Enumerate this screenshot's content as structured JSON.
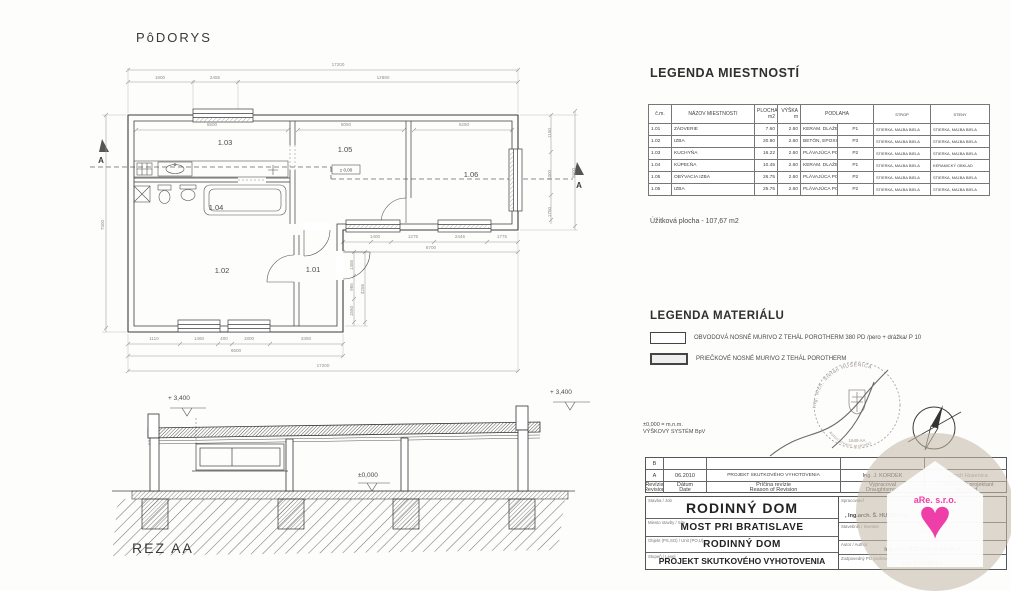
{
  "drawing": {
    "plan_title": "PôDORYS",
    "section_title": "REZ AA",
    "elevation_note_line1": "±0,000 = m.n.m.",
    "elevation_note_line2": "VÝŠKOVÝ SYSTÉM BpV"
  },
  "plan": {
    "level_label": "± 0,00",
    "section_marker_left": "A",
    "section_marker_right": "A",
    "room_labels": [
      {
        "t": "1.03",
        "x": 137,
        "y": 90
      },
      {
        "t": "1.05",
        "x": 257,
        "y": 97
      },
      {
        "t": "1.06",
        "x": 383,
        "y": 122
      },
      {
        "t": "1.04",
        "x": 128,
        "y": 155
      },
      {
        "t": "1.02",
        "x": 134,
        "y": 218
      },
      {
        "t": "1.01",
        "x": 225,
        "y": 217
      }
    ],
    "dim_labels": [
      {
        "t": "17200",
        "x": 250,
        "y": 11
      },
      {
        "t": "1800",
        "x": 72,
        "y": 24
      },
      {
        "t": "2455",
        "x": 127,
        "y": 24
      },
      {
        "t": "12890",
        "x": 295,
        "y": 24
      },
      {
        "t": "5500",
        "x": 124,
        "y": 71
      },
      {
        "t": "5050",
        "x": 258,
        "y": 71
      },
      {
        "t": "5250",
        "x": 376,
        "y": 71
      },
      {
        "t": "1150",
        "x": 463,
        "y": 78,
        "r": -90
      },
      {
        "t": "2400",
        "x": 463,
        "y": 120,
        "r": -90
      },
      {
        "t": "1750",
        "x": 463,
        "y": 157,
        "r": -90
      },
      {
        "t": "5800",
        "x": 487,
        "y": 118,
        "r": -90
      },
      {
        "t": "7300",
        "x": 16,
        "y": 170,
        "r": -90
      },
      {
        "t": "1110",
        "x": 66,
        "y": 285
      },
      {
        "t": "1460",
        "x": 111,
        "y": 285
      },
      {
        "t": "400",
        "x": 136,
        "y": 285
      },
      {
        "t": "1800",
        "x": 161,
        "y": 285
      },
      {
        "t": "3350",
        "x": 218,
        "y": 285
      },
      {
        "t": "6500",
        "x": 148,
        "y": 297
      },
      {
        "t": "17200",
        "x": 235,
        "y": 312
      },
      {
        "t": "1400",
        "x": 287,
        "y": 183
      },
      {
        "t": "1275",
        "x": 325,
        "y": 183
      },
      {
        "t": "2445",
        "x": 372,
        "y": 183
      },
      {
        "t": "1775",
        "x": 414,
        "y": 183
      },
      {
        "t": "6700",
        "x": 343,
        "y": 194
      },
      {
        "t": "1455",
        "x": 265,
        "y": 210,
        "r": -90
      },
      {
        "t": "965",
        "x": 265,
        "y": 232,
        "r": -90
      },
      {
        "t": "1550",
        "x": 265,
        "y": 256,
        "r": -90
      },
      {
        "t": "4255",
        "x": 276,
        "y": 234,
        "r": -90
      }
    ]
  },
  "section_view": {
    "level_left": "+ 3,400",
    "level_right": "+ 3,400",
    "level_zero": "±0,000"
  },
  "room_legend": {
    "title": "LEGENDA MIESTNOSTÍ",
    "col_num": "č.m.",
    "col_name": "NÁZOV MIESTNOSTI",
    "col_area": "PLOCHA",
    "col_area_unit": "m2",
    "col_height": "VÝŠKA",
    "col_height_unit": "m",
    "col_floor": "PODLAHA",
    "col_ceiling": "STROP",
    "col_walls": "STENY",
    "rows": [
      {
        "num": "1.01",
        "name": "ZÁDVERIE",
        "area": "7.60",
        "height": "2.60",
        "floor": "KERAM. DLAŽBA",
        "code": "P1",
        "ceiling": "STIERKA, MAĽBA BIELA",
        "walls": "STIERKA, MAĽBA BIELA"
      },
      {
        "num": "1.02",
        "name": "IZBA",
        "area": "20.90",
        "height": "2.60",
        "floor": "BETÓN, EPOXID. NÁTER",
        "code": "P3",
        "ceiling": "STIERKA, MAĽBA BIELA",
        "walls": "STIERKA, MAĽBA BIELA"
      },
      {
        "num": "1.03",
        "name": "KUCHYŇA",
        "area": "16.22",
        "height": "2.60",
        "floor": "PLÁVAJÚCA PODLAHA",
        "code": "P2",
        "ceiling": "STIERKA, MAĽBA BIELA",
        "walls": "STIERKA, MAĽBA BIELA"
      },
      {
        "num": "1.04",
        "name": "KÚPEĽŇA",
        "area": "10.45",
        "height": "2.60",
        "floor": "KERAM. DLAŽBA",
        "code": "P1",
        "ceiling": "STIERKA, MAĽBA BIELA",
        "walls": "KERAMICKÝ OBKLAD"
      },
      {
        "num": "1.05",
        "name": "OBÝVACIA IZBA",
        "area": "26.75",
        "height": "2.60",
        "floor": "PLÁVAJÚCA PODLAHA",
        "code": "P2",
        "ceiling": "STIERKA, MAĽBA BIELA",
        "walls": "STIERKA, MAĽBA BIELA"
      },
      {
        "num": "1.05",
        "name": "IZBA",
        "area": "25.75",
        "height": "2.60",
        "floor": "PLÁVAJÚCA PODLAHA",
        "code": "P2",
        "ceiling": "STIERKA, MAĽBA BIELA",
        "walls": "STIERKA, MAĽBA BIELA"
      }
    ],
    "usable_area": "Úžitková plocha - 107,67 m2"
  },
  "material_legend": {
    "title": "LEGENDA MATERIÁLU",
    "items": [
      {
        "label": "OBVODOVÁ NOSNÉ MURIVO Z TEHÁL POROTHERM 380 PD /pero + drážka/  P 10"
      },
      {
        "label": "PRIEČKOVÉ NOSNÉ MURIVO Z TEHÁL POROTHERM"
      }
    ]
  },
  "stamp": {
    "arc_text": "Ing. arch. Štefan HUSENICA",
    "inner_text": "autorizovaný architekt",
    "number": "1649 AA"
  },
  "title_block": {
    "rev_rows": [
      {
        "letter": "B",
        "date": "",
        "desc": "",
        "by": "",
        "appr": ""
      },
      {
        "letter": "A",
        "date": "06.2010",
        "desc": "PROJEKT SKUTKOVÉHO VYHOTOVENIA",
        "by": "Ing. J. KORDEK",
        "appr": "Ing.arch Husenica"
      }
    ],
    "rev_col_labels": {
      "letter": [
        "Revízia",
        "Revision"
      ],
      "date": [
        "Dátum",
        "Date"
      ],
      "desc": [
        "Príčina revízie",
        "Reason of Revision"
      ],
      "by": [
        "Vypracoval",
        "Draughtsman"
      ],
      "appr": [
        "Zodpovedný projektant",
        "Approved"
      ]
    },
    "f1_label": "Stavba / Job",
    "f1_value": "RODINNÝ DOM",
    "f2_label": "Miesto stavby / Site",
    "f2_value": "MOST PRI BRATISLAVE",
    "f3_label": "Objekt (PS,SO) / Unit (PO,U)",
    "f3_value": "RODINNÝ DOM",
    "f4_label": "Stupeň / Level",
    "f4_value": "PROJEKT SKUTKOVÉHO VYHOTOVENIA",
    "r1_label": "Spracovateľ",
    "r1_value": ", Ing.arch. Š. HUSENICA,",
    "r2_label": "Stavebník / Investor",
    "r2_value": "JARO",
    "r3_label": "Autor / Author",
    "r3_value": "Ing.arch. ŠTEFAN HUSENICA",
    "r4_label": "Zodpovedný PO profesie / Contractor of branch",
    "r4_value": "Ing. J. KORDEK"
  },
  "watermark": {
    "logo_text": "aRe. s.r.o.",
    "heart_color": "#ee3fa8",
    "heart_glyph": "♥"
  }
}
